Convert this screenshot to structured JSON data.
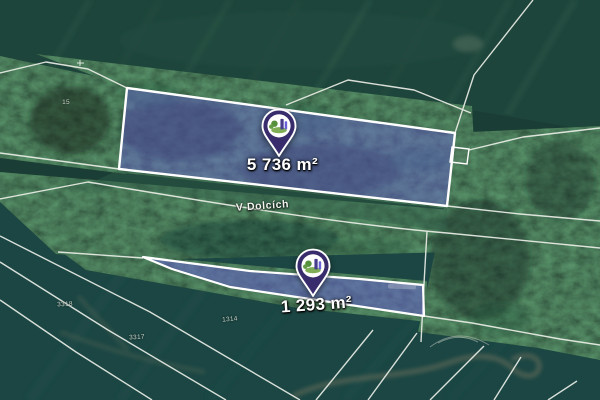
{
  "map": {
    "street": "V Dolcích",
    "markers": [
      {
        "area": "5 736 m²"
      },
      {
        "area": "1 293 m²"
      }
    ],
    "parcel_numbers": [
      {
        "text": "15"
      },
      {
        "text": "3318"
      },
      {
        "text": "3317"
      },
      {
        "text": "1314"
      }
    ],
    "colors": {
      "parcel_fill": "#6a60d8",
      "parcel_border": "#ffffff",
      "pin_body": "#382c6d",
      "cadastral_line": "#eef1ea"
    }
  }
}
